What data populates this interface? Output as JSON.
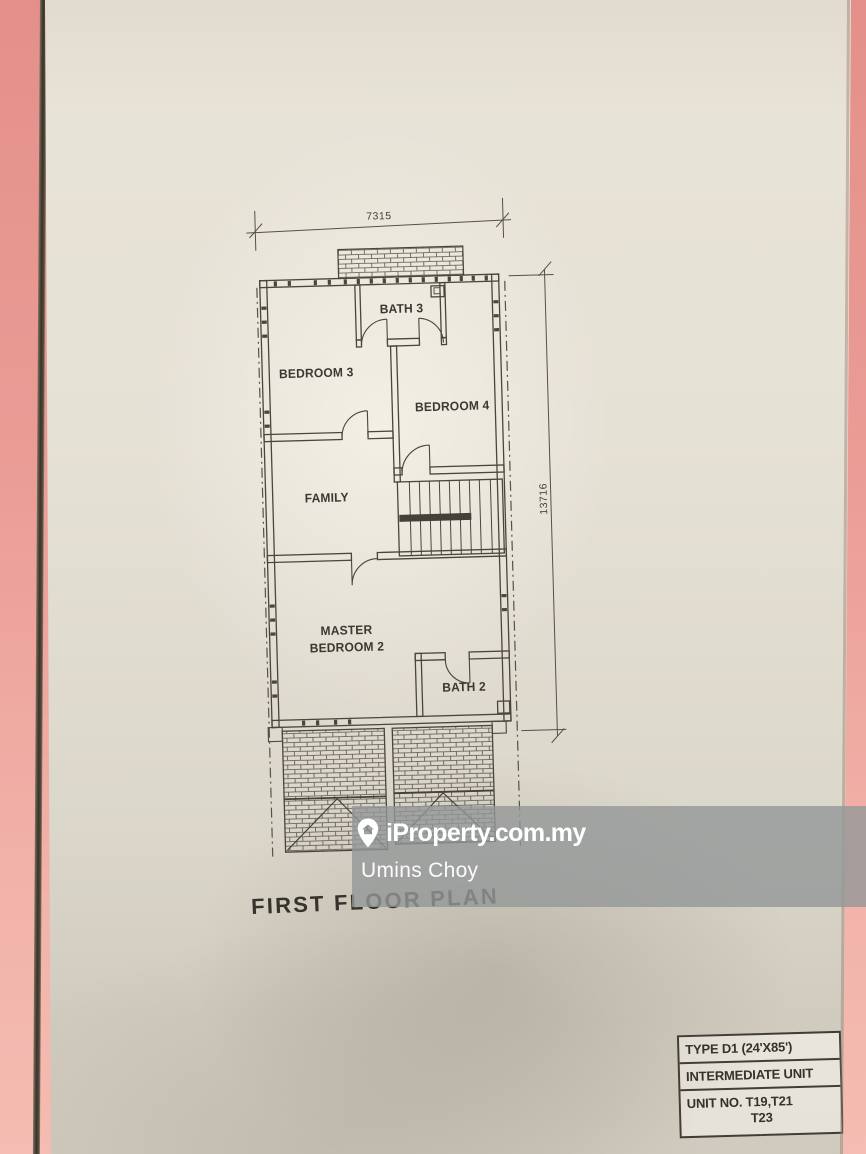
{
  "plan": {
    "title": "FIRST FLOOR PLAN",
    "dimensions": {
      "top": "7315",
      "right": "13716"
    },
    "rooms": [
      {
        "label": "BATH 3"
      },
      {
        "label": "BEDROOM 3"
      },
      {
        "label": "BEDROOM 4"
      },
      {
        "label": "FAMILY"
      },
      {
        "label_line1": "MASTER",
        "label_line2": "BEDROOM 2"
      },
      {
        "label": "BATH 2"
      }
    ]
  },
  "info_table": {
    "rows": [
      {
        "text": "TYPE D1 (24'X85')"
      },
      {
        "text": "INTERMEDIATE UNIT"
      },
      {
        "text": "UNIT NO. T19,T21",
        "text2": "T23"
      }
    ]
  },
  "watermark": {
    "brand": "iProperty.com.my",
    "agent": "Umins Choy",
    "icon": "map-pin-house-icon",
    "band_color": "#97999b"
  },
  "colors": {
    "paper": "#e6e1d5",
    "pink_surface": "#ec9d96",
    "ink": "#474339"
  }
}
